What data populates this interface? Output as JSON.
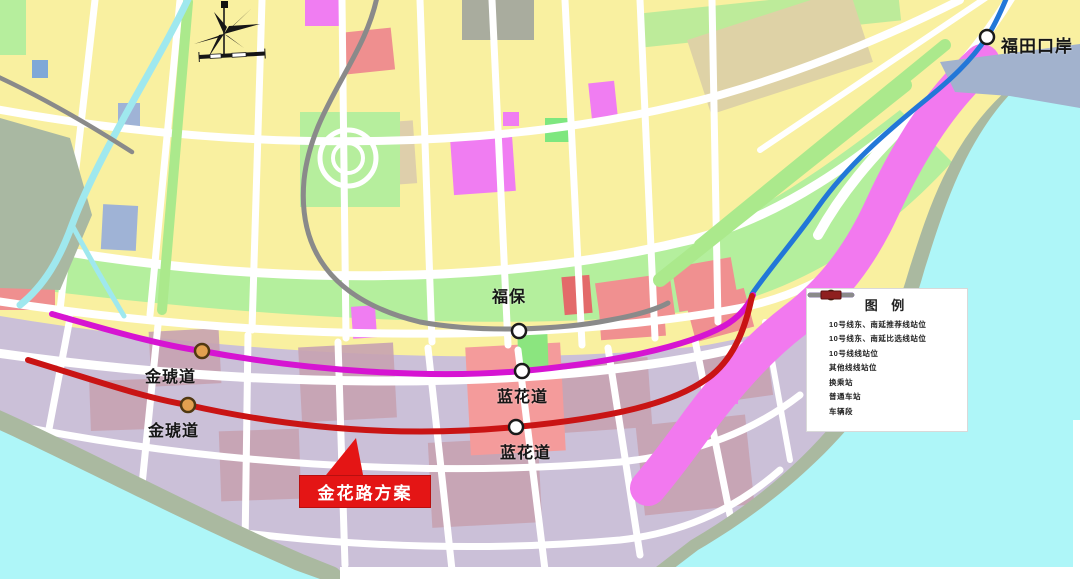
{
  "map": {
    "station_labels": [
      {
        "text": "福田口岸",
        "marker": "normal-station"
      },
      {
        "text": "福保",
        "marker": "normal-station"
      },
      {
        "text": "金琥道",
        "marker": "interchange-station"
      },
      {
        "text": "金琥道",
        "marker": "interchange-station"
      },
      {
        "text": "蓝花道",
        "marker": "normal-station"
      },
      {
        "text": "蓝花道",
        "marker": "normal-station"
      }
    ],
    "callout_label": "金花路方案"
  },
  "legend": {
    "title": "图 例",
    "items": [
      {
        "label": "10号线东、南延推荐线站位",
        "swatch": "line",
        "color": "#c91414"
      },
      {
        "label": "10号线东、南延比选线站位",
        "swatch": "line",
        "color": "#d614d2"
      },
      {
        "label": "10号线线站位",
        "swatch": "line",
        "color": "#2277d8"
      },
      {
        "label": "其他线线站位",
        "swatch": "line",
        "color": "#8a8a8a"
      },
      {
        "label": "换乘站",
        "swatch": "interchange-station",
        "color": "#e2a050"
      },
      {
        "label": "普通车站",
        "swatch": "normal-station",
        "color": "#ffffff"
      },
      {
        "label": "车辆段",
        "swatch": "depot",
        "color": "#8f1f1f"
      }
    ]
  },
  "colors": {
    "line_recommended": "#c91414",
    "line_alternative": "#d614d2",
    "line_10": "#2277d8",
    "line_other": "#8a8a8a",
    "station_interchange_fill": "#e2a050",
    "water": "#aef6f8",
    "callout_bg": "#e41515"
  }
}
